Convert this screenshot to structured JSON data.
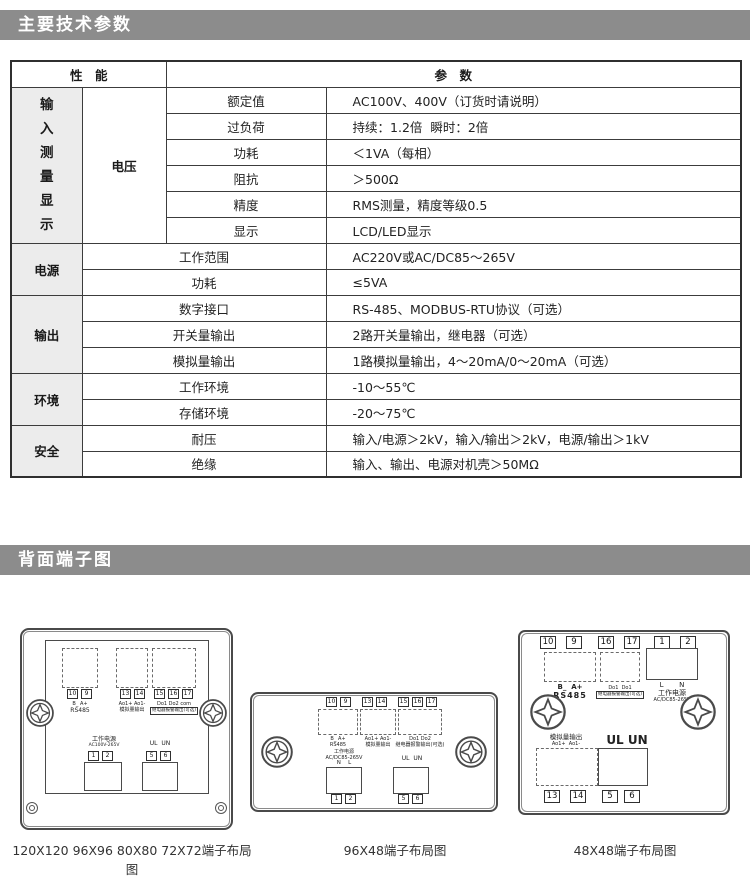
{
  "page": {
    "background": "#ffffff",
    "bar_color": "#8c8c8c"
  },
  "section1": {
    "title": "主要技术参数"
  },
  "section2": {
    "title": "背面端子图"
  },
  "table": {
    "header": {
      "perf": "性　能",
      "param": "参　数"
    },
    "groups": [
      {
        "label": "输入测量显示",
        "sub": "电压",
        "rows": [
          {
            "param": "额定值",
            "value": "AC100V、400V（订货时请说明）"
          },
          {
            "param": "过负荷",
            "value": "持续：1.2倍  瞬时：2倍"
          },
          {
            "param": "功耗",
            "value": "＜1VA（每相）"
          },
          {
            "param": "阻抗",
            "value": "＞500Ω"
          },
          {
            "param": "精度",
            "value": "RMS测量，精度等级0.5"
          },
          {
            "param": "显示",
            "value": "LCD/LED显示"
          }
        ]
      },
      {
        "label": "电源",
        "rows": [
          {
            "param": "工作范围",
            "value": "AC220V或AC/DC85～265V"
          },
          {
            "param": "功耗",
            "value": "≤5VA"
          }
        ]
      },
      {
        "label": "输出",
        "rows": [
          {
            "param": "数字接口",
            "value": "RS-485、MODBUS-RTU协议（可选）"
          },
          {
            "param": "开关量输出",
            "value": "2路开关量输出，继电器（可选）"
          },
          {
            "param": "模拟量输出",
            "value": "1路模拟量输出，4～20mA/0～20mA（可选）"
          }
        ]
      },
      {
        "label": "环境",
        "rows": [
          {
            "param": "工作环境",
            "value": "-10～55℃"
          },
          {
            "param": "存储环境",
            "value": "-20～75℃"
          }
        ]
      },
      {
        "label": "安全",
        "rows": [
          {
            "param": "耐压",
            "value": "输入/电源＞2kV，输入/输出＞2kV，电源/输出＞1kV"
          },
          {
            "param": "绝缘",
            "value": "输入、输出、电源对机壳＞50MΩ"
          }
        ]
      }
    ]
  },
  "diagrams": {
    "large": {
      "caption": "120X120 96X96 80X80 72X72端子布局图",
      "rs485": {
        "t1": "10",
        "t2": "9",
        "pins": "B_ A+",
        "label": "RS485"
      },
      "analog": {
        "t1": "13",
        "t2": "14",
        "pins": "Ao1+ Ao1-",
        "label": "模拟量输出"
      },
      "relay": {
        "t1": "15",
        "t2": "16",
        "t3": "17",
        "pins": "Do1 Do2 com",
        "label": "继电器报警输出(可选)"
      },
      "power": {
        "label": "工作电源",
        "range": "AC100V-265V",
        "t1": "1",
        "t2": "2"
      },
      "volt": {
        "label": "UL  UN",
        "t1": "5",
        "t2": "6"
      }
    },
    "mid": {
      "caption": "96X48端子布局图",
      "rs485": {
        "t1": "10",
        "t2": "9",
        "text": "B_ A+\nRS485"
      },
      "analog": {
        "t1": "13",
        "t2": "14",
        "text": "Ao1+ Ao1-\n模拟量输出"
      },
      "relay": {
        "t1": "15",
        "t2": "16",
        "t3": "17",
        "text": "Do1 Do2\n继电器报警输出(可选)"
      },
      "power": {
        "text": "工作电源\nAC/DC85-265V",
        "pins": "N　 L",
        "t1": "1",
        "t2": "2"
      },
      "volt": {
        "label": "UL  UN",
        "t1": "5",
        "t2": "6"
      }
    },
    "small": {
      "caption": "48X48端子布局图",
      "top_terminals": [
        "10",
        "9",
        "16",
        "17",
        "1",
        "2"
      ],
      "rs485": {
        "pins": "B_  A+",
        "label": "RS485"
      },
      "relay": {
        "pins": "Do1  Do1",
        "label": "继电器报警输出(可选)"
      },
      "power": {
        "pins": "L       N",
        "label": "工作电源",
        "range": "AC/DC85-265V"
      },
      "analog": {
        "label": "模拟量输出",
        "pins": "Ao1+  Ao1-",
        "t1": "13",
        "t2": "14"
      },
      "volt": {
        "label": "UL UN",
        "t1": "5",
        "t2": "6"
      }
    }
  }
}
